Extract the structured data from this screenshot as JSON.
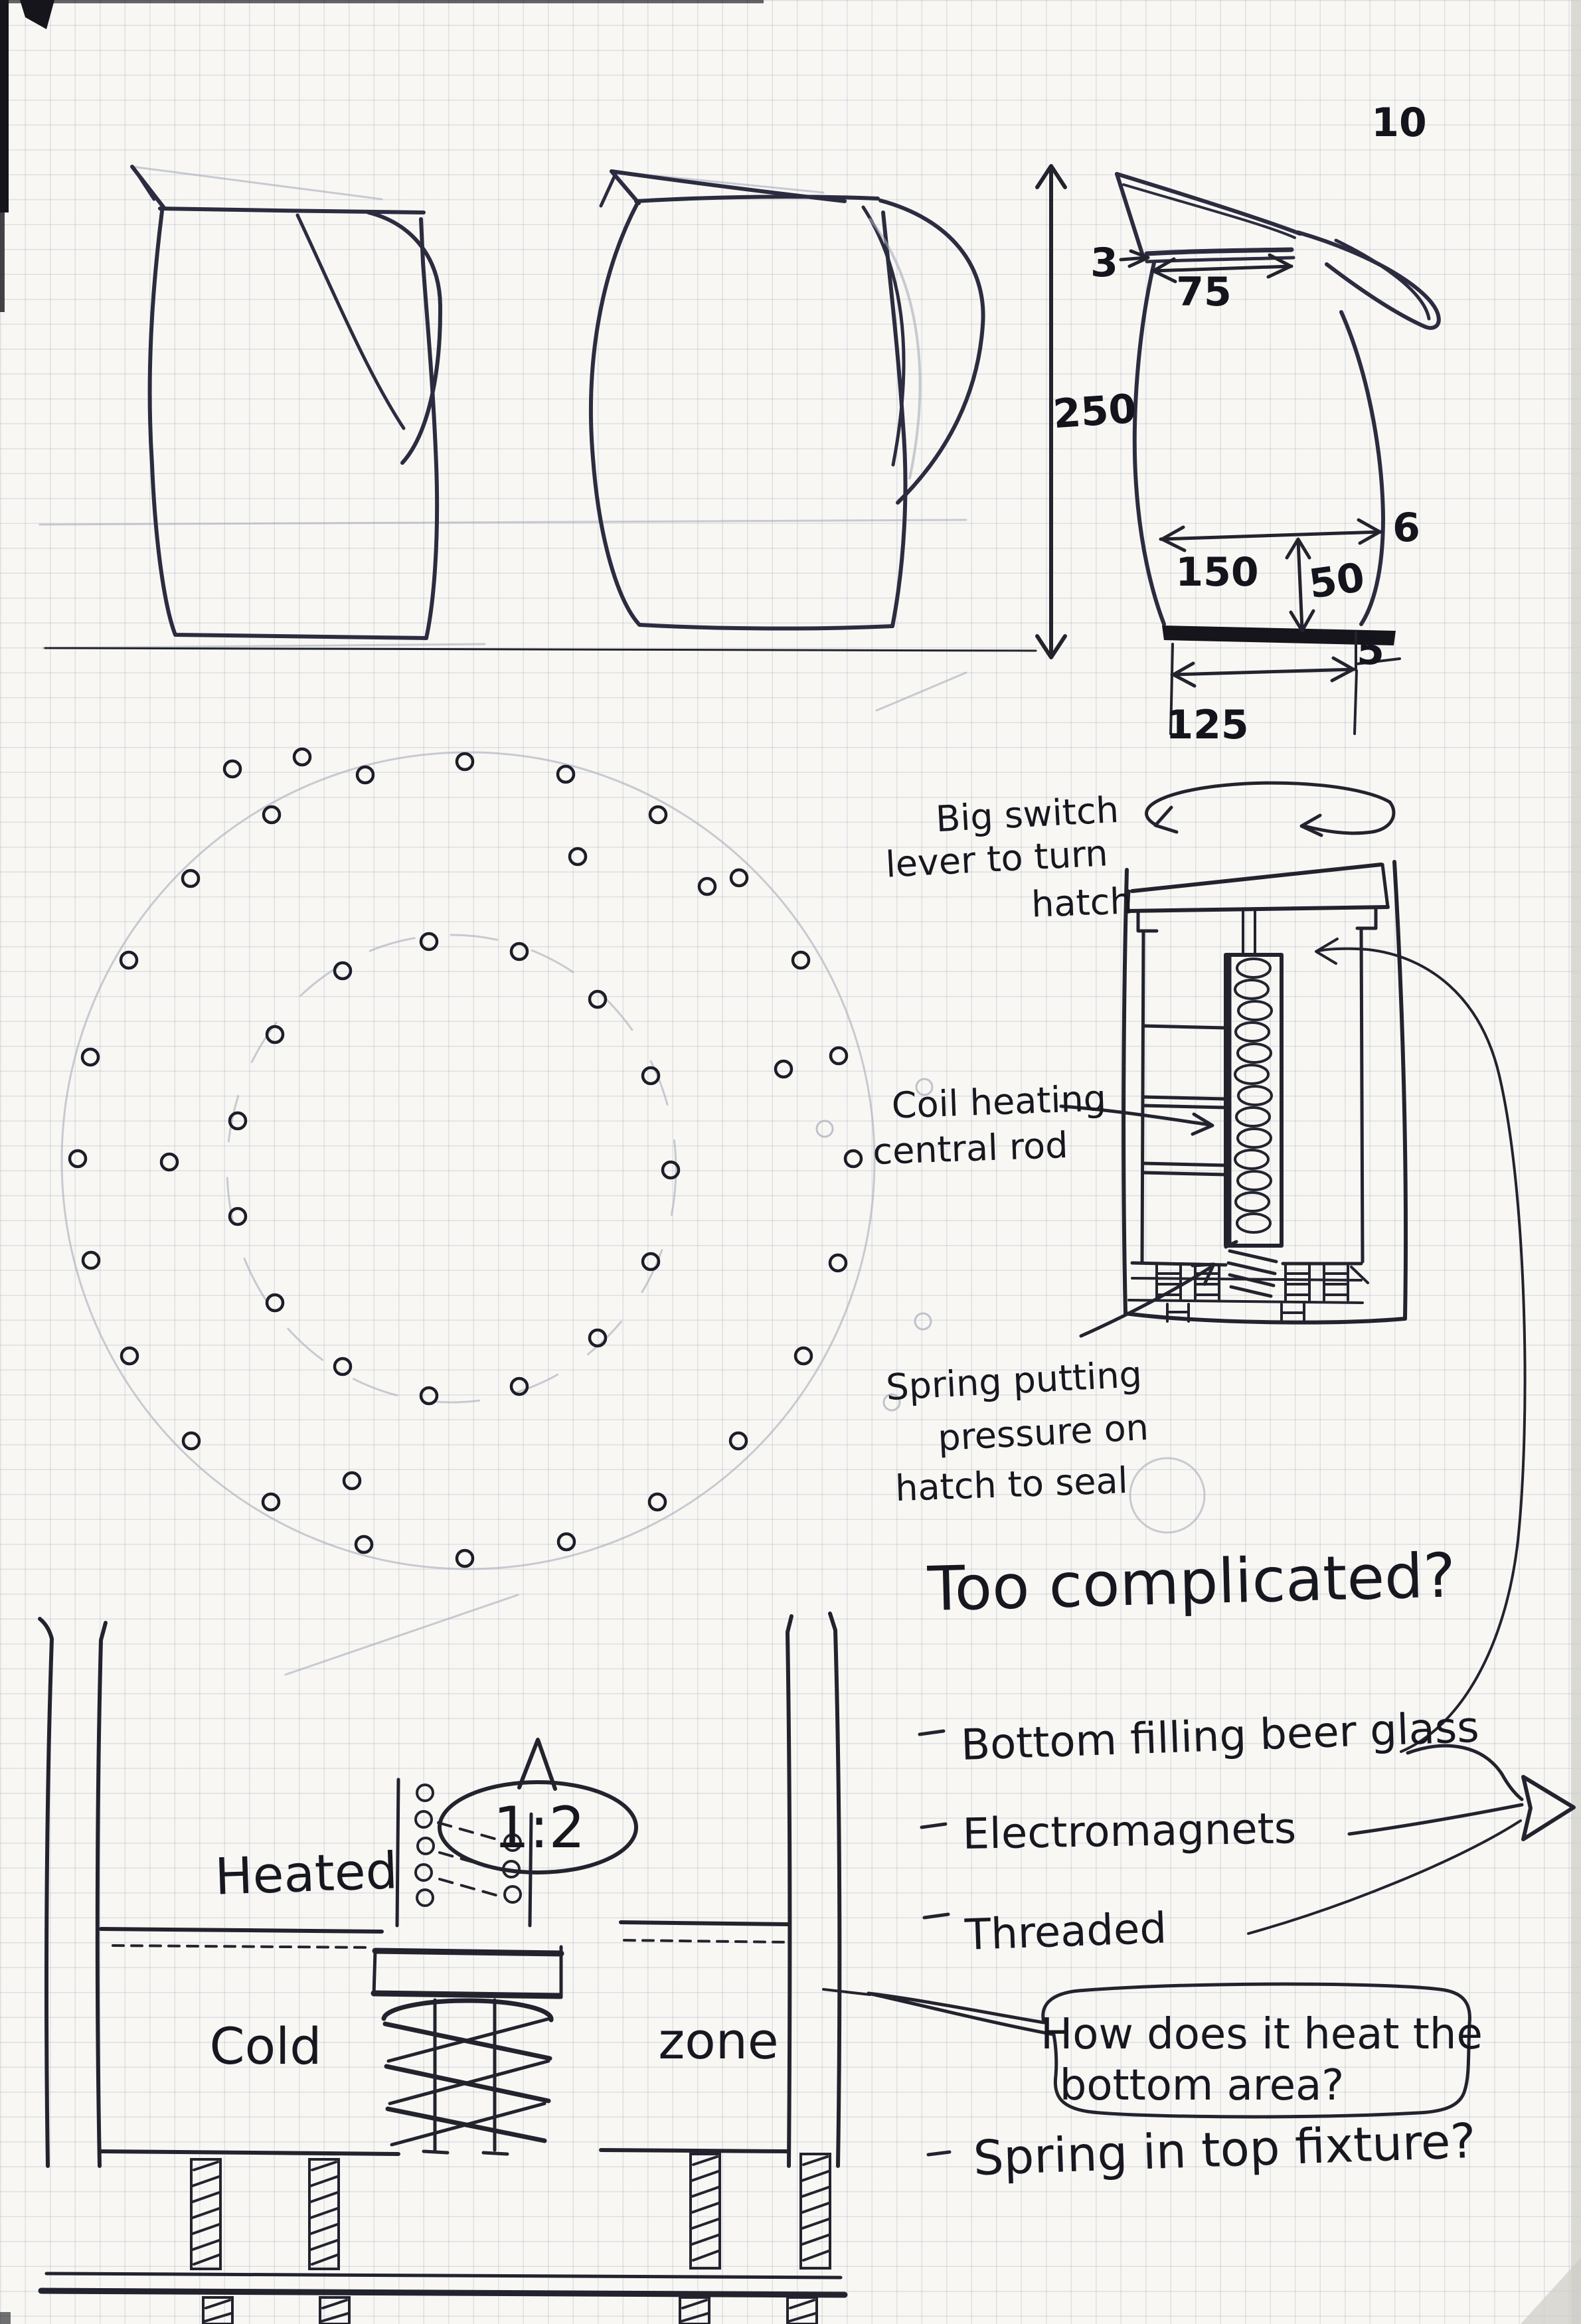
{
  "sketch": {
    "dimensions": {
      "spout": "10",
      "lid_thickness": "3",
      "lid_width": "75",
      "height": "250",
      "body_width": "150",
      "neck_height": "50",
      "wall": "6",
      "base_thickness": "5",
      "base_width": "125"
    },
    "mechanism_notes": {
      "switch_line1": "Big switch",
      "switch_line2": "lever to turn",
      "switch_line3": "hatch",
      "coil_line1": "Coil heating",
      "coil_line2": "central rod",
      "spring_line1": "Spring putting",
      "spring_line2": "pressure on",
      "spring_line3": "hatch to seal"
    },
    "review": {
      "question": "Too complicated?",
      "ideas": [
        "Bottom filling beer glass",
        "Electromagnets",
        "Threaded"
      ],
      "bubble_line1": "How does it heat the",
      "bubble_line2": "bottom area?",
      "followup": "Spring in top fixture?"
    },
    "section_labels": {
      "heated": "Heated",
      "cold": "Cold",
      "zone": "zone",
      "scale": "1:2"
    },
    "holes": [
      [
        1285,
        1745
      ],
      [
        1262,
        1902
      ],
      [
        1210,
        2042
      ],
      [
        1112,
        2170
      ],
      [
        990,
        2262
      ],
      [
        853,
        2322
      ],
      [
        700,
        2347
      ],
      [
        548,
        2326
      ],
      [
        408,
        2262
      ],
      [
        288,
        2170
      ],
      [
        195,
        2042
      ],
      [
        137,
        1898
      ],
      [
        117,
        1745
      ],
      [
        136,
        1592
      ],
      [
        194,
        1446
      ],
      [
        287,
        1323
      ],
      [
        409,
        1227
      ],
      [
        550,
        1167
      ],
      [
        700,
        1147
      ],
      [
        852,
        1166
      ],
      [
        991,
        1227
      ],
      [
        1113,
        1322
      ],
      [
        1206,
        1446
      ],
      [
        1263,
        1590
      ],
      [
        1010,
        1762
      ],
      [
        980,
        1900
      ],
      [
        900,
        2015
      ],
      [
        782,
        2088
      ],
      [
        646,
        2102
      ],
      [
        516,
        2058
      ],
      [
        414,
        1962
      ],
      [
        358,
        1832
      ],
      [
        358,
        1688
      ],
      [
        414,
        1558
      ],
      [
        516,
        1462
      ],
      [
        646,
        1418
      ],
      [
        782,
        1433
      ],
      [
        900,
        1505
      ],
      [
        980,
        1620
      ],
      [
        350,
        1158
      ],
      [
        455,
        1140
      ],
      [
        870,
        1290
      ],
      [
        1180,
        1610
      ],
      [
        255,
        1750
      ],
      [
        530,
        2230
      ],
      [
        1065,
        1335
      ]
    ],
    "faint_holes": [
      [
        1392,
        1637
      ],
      [
        1242,
        1700
      ],
      [
        1390,
        1990
      ],
      [
        1343,
        2112
      ]
    ],
    "colors": {
      "ink": "#23232e",
      "pencil": "#a6abb8",
      "paper": "#f8f7f4",
      "grid": "#c3c8d4"
    }
  }
}
